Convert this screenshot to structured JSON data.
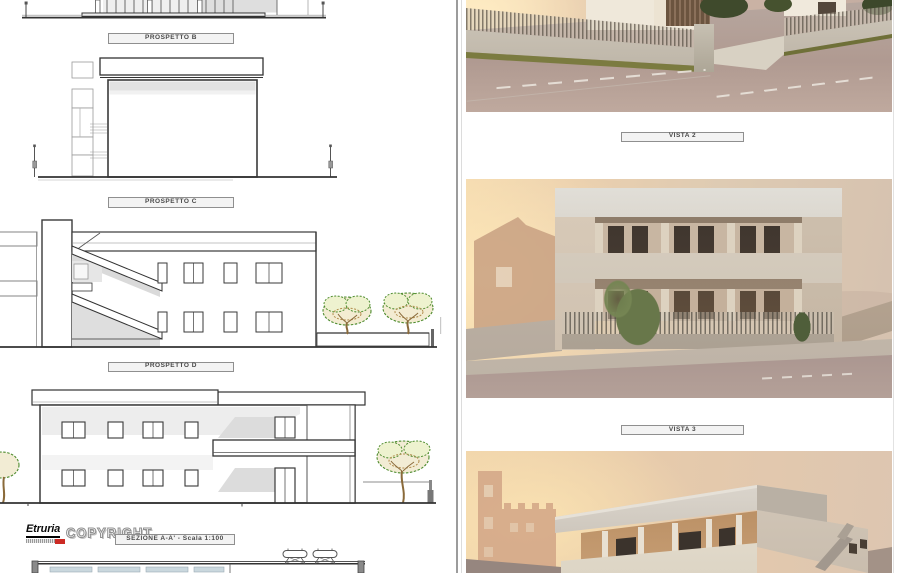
{
  "left_sheet": {
    "plates": {
      "prospetto_b": "PROSPETTO B",
      "prospetto_c": "PROSPETTO C",
      "prospetto_d": "PROSPETTO D",
      "sezione_aa": "SEZIONE A-A' - Scala 1:100"
    },
    "watermark": {
      "brand": "Etruria",
      "copyright": "COPYRIGHT"
    },
    "drawings": [
      "prospetto-b-elevation-bottom-cut",
      "prospetto-c-elevation",
      "prospetto-d-stair-section",
      "sezione-aa-elevation",
      "lower-section-top-cut"
    ]
  },
  "right_sheet": {
    "plates": {
      "vista_2": "VISTA 2",
      "vista_3": "VISTA 3"
    },
    "renders": [
      "street-corner-sunset-render",
      "front-facade-sunset-render",
      "roof-corner-sunset-render"
    ]
  },
  "colors": {
    "paper": "#ffffff",
    "plate_bg": "#f3f3f3",
    "plate_border": "#8f8f8f",
    "plate_text": "#4a4a4a",
    "line_dark": "#3a3a3a",
    "shade_gray": "#e3e3e3",
    "tree_green": "#4e8c2f",
    "trunk_brown": "#8a6a3a",
    "logo_red": "#cc2a24",
    "sunset_glow": "#f5deb4",
    "sky_warm": "#e8cdad",
    "road_mauve": "#a8938e",
    "facade_beige": "#c8b6a2",
    "roof_gray": "#d6d0c6"
  }
}
